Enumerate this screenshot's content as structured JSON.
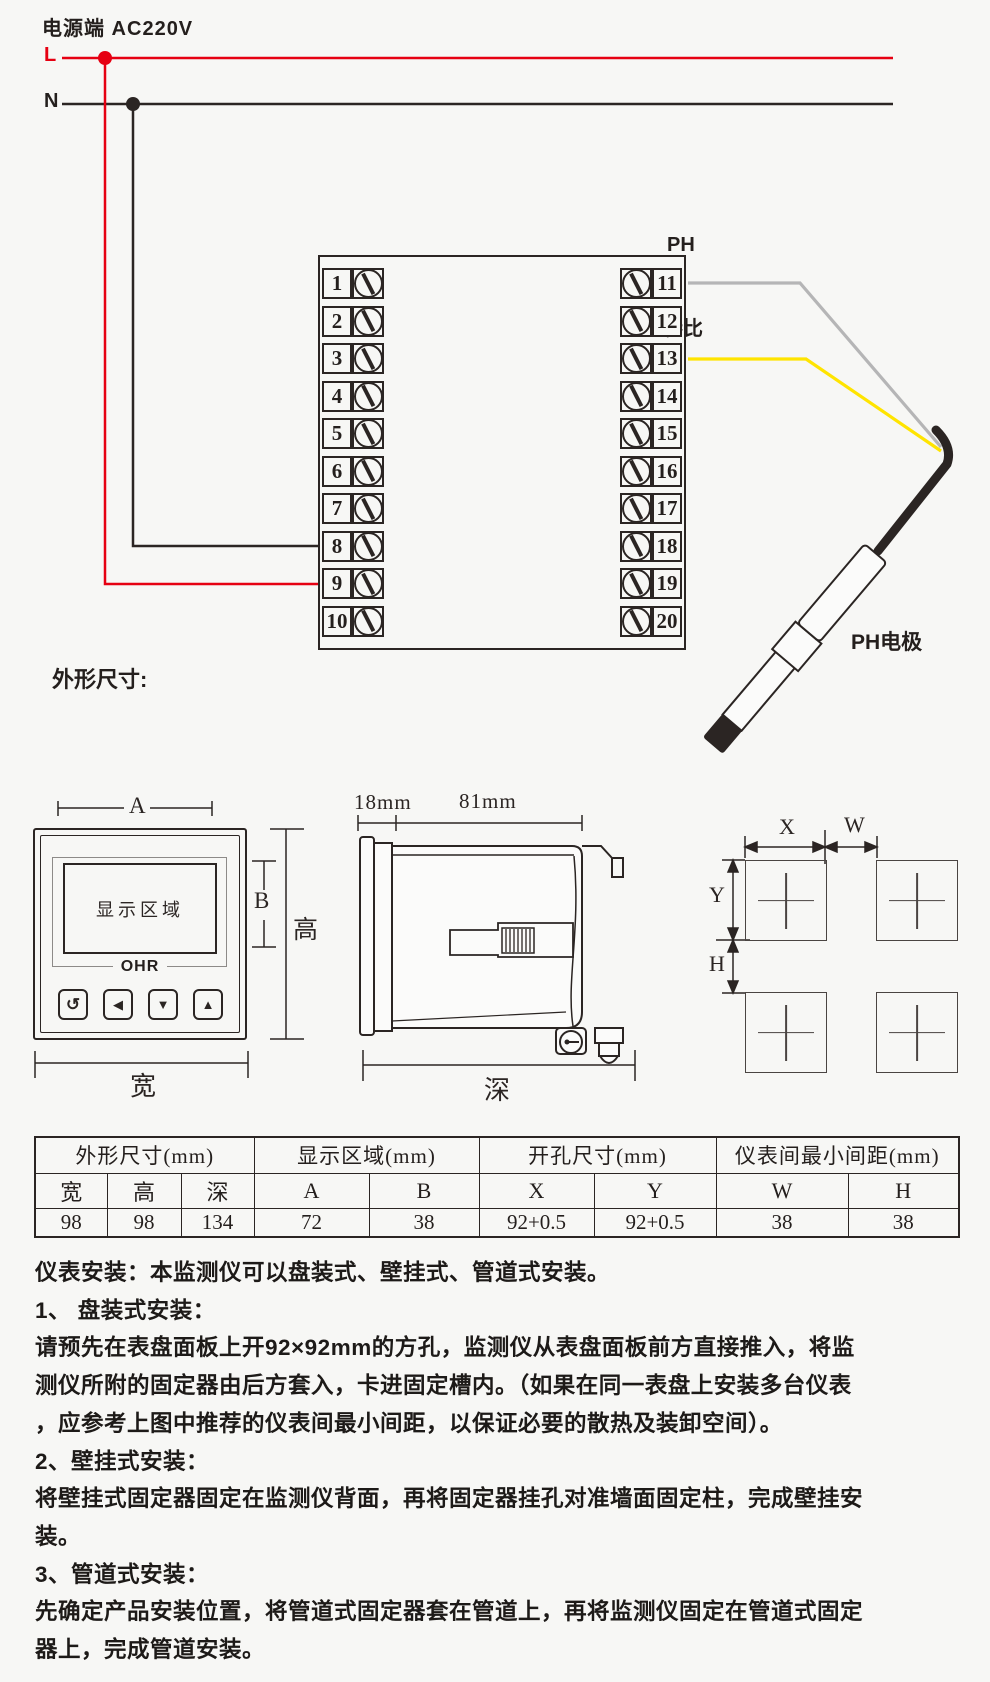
{
  "colors": {
    "red": "#e60012",
    "ink": "#2b2523",
    "wire_ph": "#b5b5b6",
    "wire_ref": "#ffe400"
  },
  "power": {
    "title": "电源端  AC220V",
    "l": "L",
    "n": "N"
  },
  "terminal_block": {
    "left": [
      "1",
      "2",
      "3",
      "4",
      "5",
      "6",
      "7",
      "8",
      "9",
      "10"
    ],
    "right": [
      "11",
      "12",
      "13",
      "14",
      "15",
      "16",
      "17",
      "18",
      "19",
      "20"
    ]
  },
  "wiring": {
    "ph": "PH",
    "ref": "参比",
    "electrode": "PH电极"
  },
  "outline": {
    "title": "外形尺寸:",
    "front": {
      "display": "显示区域",
      "logo": "OHR",
      "dim_a": "A",
      "dim_b": "B",
      "dim_height": "高",
      "dim_width": "宽",
      "buttons": [
        "↺",
        "◀",
        "▼",
        "▲"
      ]
    },
    "side": {
      "dim_bezel": "18mm",
      "dim_body": "81mm",
      "dim_depth": "深"
    },
    "cutout": {
      "dim_x": "X",
      "dim_w": "W",
      "dim_y": "Y",
      "dim_h": "H"
    }
  },
  "table": {
    "groups": [
      {
        "label": "外形尺寸(mm)",
        "cols": [
          "宽",
          "高",
          "深"
        ],
        "values": [
          "98",
          "98",
          "134"
        ]
      },
      {
        "label": "显示区域(mm)",
        "cols": [
          "A",
          "B"
        ],
        "values": [
          "72",
          "38"
        ]
      },
      {
        "label": "开孔尺寸(mm)",
        "cols": [
          "X",
          "Y"
        ],
        "values": [
          "92+0.5",
          "92+0.5"
        ]
      },
      {
        "label": "仪表间最小间距(mm)",
        "cols": [
          "W",
          "H"
        ],
        "values": [
          "38",
          "38"
        ]
      }
    ]
  },
  "instructions": {
    "lines": [
      "仪表安装：本监测仪可以盘装式、壁挂式、管道式安装。",
      "1、 盘装式安装：",
      "请预先在表盘面板上开92×92mm的方孔，监测仪从表盘面板前方直接推入，将监",
      "测仪所附的固定器由后方套入，卡进固定槽内。（如果在同一表盘上安装多台仪表",
      "，应参考上图中推荐的仪表间最小间距，以保证必要的散热及装卸空间）。",
      "2、壁挂式安装：",
      "将壁挂式固定器固定在监测仪背面，再将固定器挂孔对准墙面固定柱，完成壁挂安",
      "装。",
      "3、管道式安装：",
      "先确定产品安装位置，将管道式固定器套在管道上，再将监测仪固定在管道式固定",
      "器上，完成管道安装。"
    ]
  }
}
